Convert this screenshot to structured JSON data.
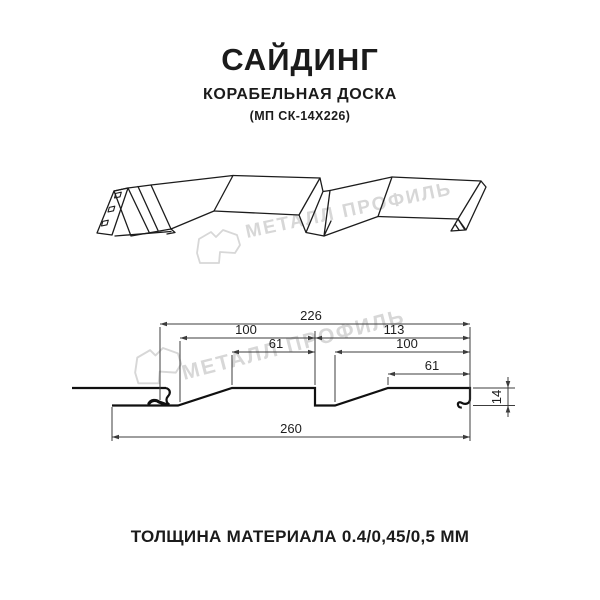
{
  "header": {
    "title": "САЙДИНГ",
    "subtitle": "КОРАБЕЛЬНАЯ ДОСКА",
    "model_code": "(МП СК-14Х226)"
  },
  "watermarks": {
    "brand_text": "МЕТАЛЛ ПРОФИЛЬ",
    "color": "#d7d7d7"
  },
  "cross_section": {
    "dimensions": {
      "panel_width_top": "226",
      "left_board_width": "100",
      "left_board_flat": "61",
      "right_board_width": "113",
      "right_board_inner": "100",
      "right_board_flat": "61",
      "overall_width": "260",
      "profile_height": "14"
    }
  },
  "footer": {
    "material_thickness": "ТОЛЩИНА МАТЕРИАЛА 0.4/0,45/0,5 ММ"
  },
  "colors": {
    "line": "#1c1c1c",
    "dimension": "#3c3c3c",
    "watermark": "#d7d7d7",
    "background": "#ffffff"
  }
}
